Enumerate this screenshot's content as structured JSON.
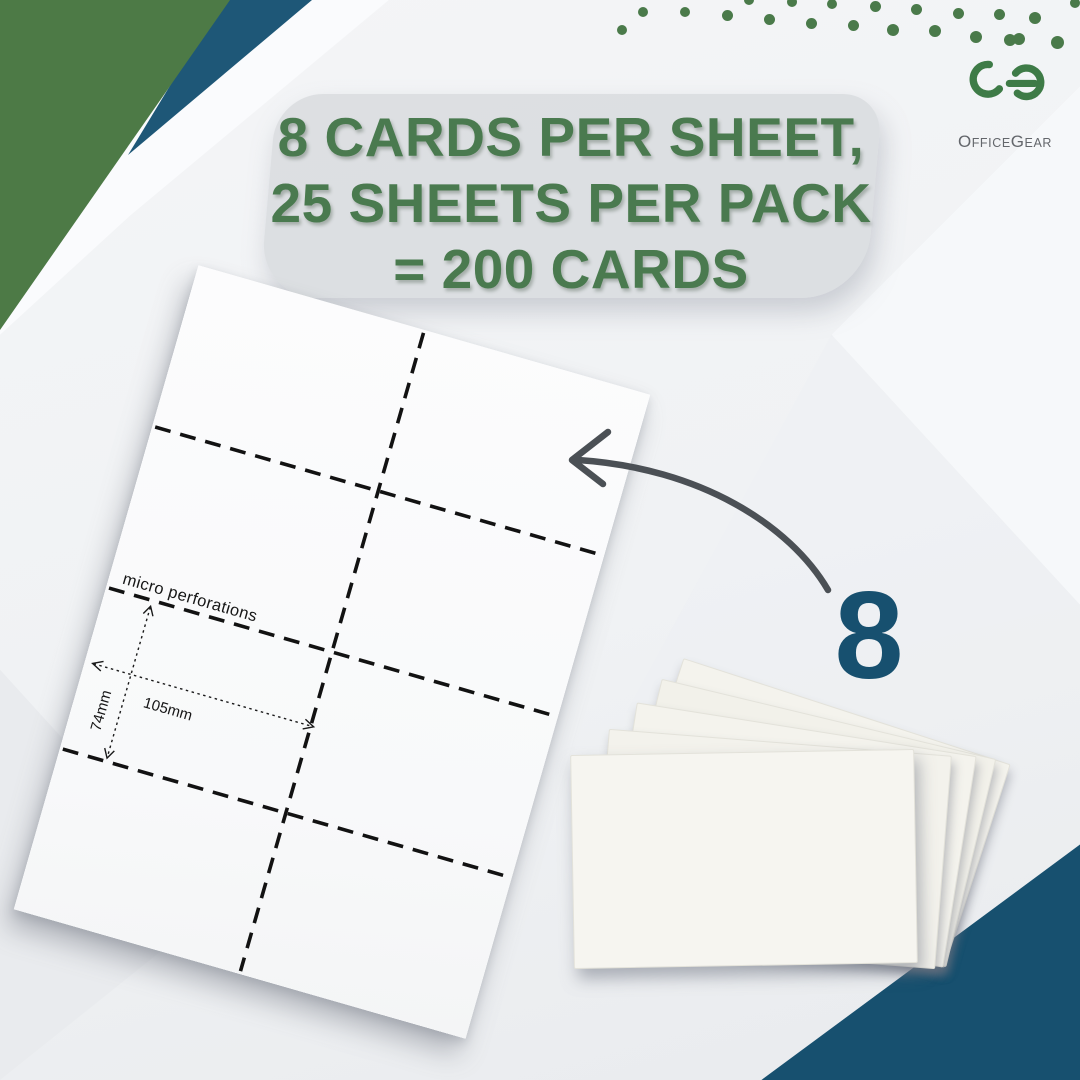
{
  "headline": {
    "lines": [
      "8 CARDS PER SHEET,",
      "25 SHEETS PER PACK",
      "= 200 CARDS"
    ]
  },
  "logo": {
    "brand": "OfficeGear",
    "brand_parts": [
      "O",
      "ffice",
      "G",
      "ear"
    ]
  },
  "sheet": {
    "grid": {
      "cols": 2,
      "rows": 4
    },
    "labels": {
      "perforation": "micro perforations",
      "card_width": "105mm",
      "card_height": "74mm"
    }
  },
  "callout": {
    "cards_per_sheet": "8"
  },
  "colors": {
    "headline_green": "#4a7a4f",
    "logo_green": "#3e7b47",
    "logo_gray": "#63666b",
    "navy": "#17506f",
    "corner_green": "#4d7a46",
    "corner_navy": "#1e5777",
    "arrow_gray": "#4b5055",
    "dot_green": "#4a7a4a"
  },
  "decor": {
    "dots": [
      [
        622,
        30,
        5
      ],
      [
        643,
        12,
        5
      ],
      [
        685,
        12,
        5
      ],
      [
        727,
        15,
        5.5
      ],
      [
        749,
        0,
        5
      ],
      [
        769,
        19,
        5.5
      ],
      [
        792,
        2,
        5
      ],
      [
        811,
        23,
        5.5
      ],
      [
        832,
        4,
        5
      ],
      [
        853,
        25,
        5.5
      ],
      [
        875,
        6,
        5.5
      ],
      [
        893,
        30,
        6
      ],
      [
        916,
        9,
        5.5
      ],
      [
        935,
        31,
        6
      ],
      [
        958,
        13,
        5.5
      ],
      [
        976,
        37,
        6
      ],
      [
        999,
        14,
        5.5
      ],
      [
        1019,
        39,
        6
      ],
      [
        1035,
        18,
        6
      ],
      [
        1010,
        40,
        6
      ],
      [
        1057,
        42,
        6.5
      ],
      [
        1075,
        3,
        5
      ]
    ]
  }
}
